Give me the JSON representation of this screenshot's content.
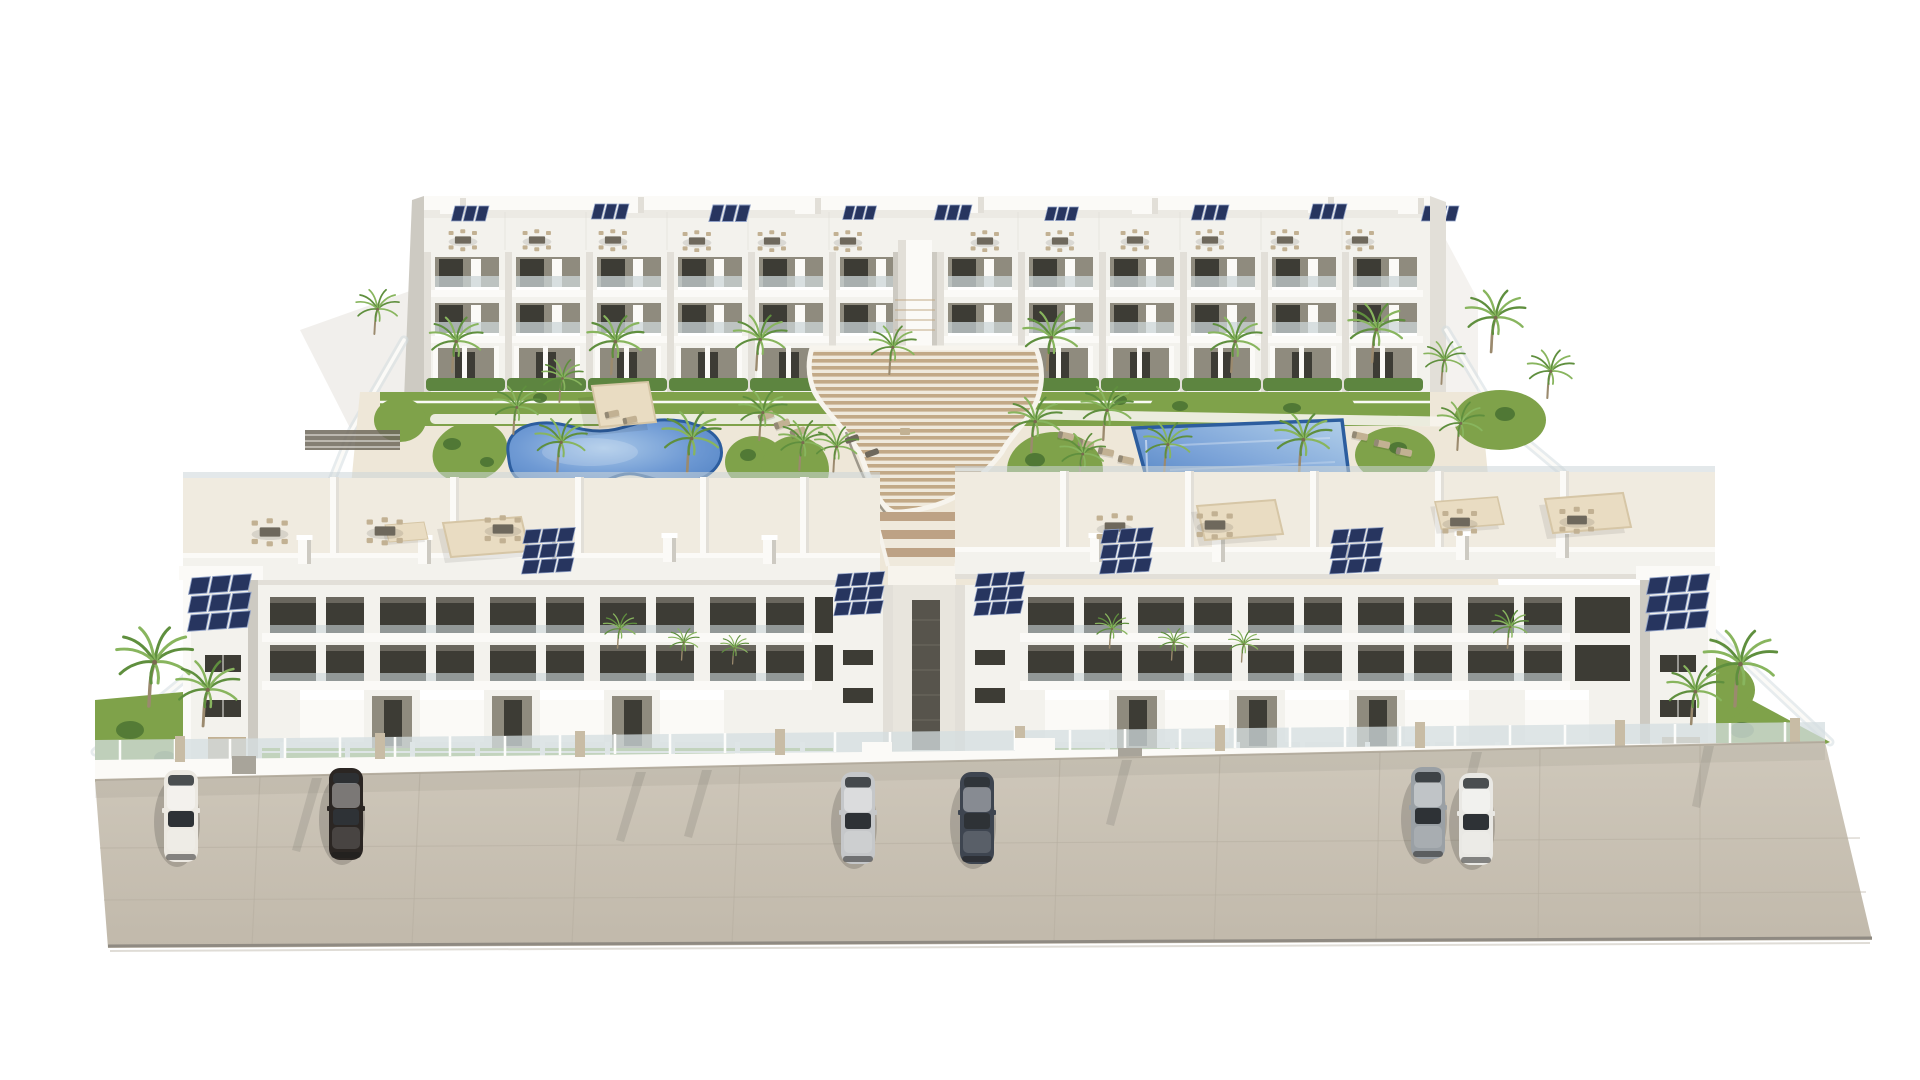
{
  "scene": {
    "description": "Aerial 3D architectural rendering of a white modern residential apartment complex: two rows of three-storey blocks around a landscaped courtyard with a kidney-shaped pool, a rectangular pool, a central curved wooden amphitheater walkway, rooftop terraces with dining sets and navy solar panels, many palm trees, a glass perimeter fence and six cars parked on the beige front street.",
    "objects": {
      "apartment_blocks": 4,
      "swimming_pools": 2,
      "pergolas": 2,
      "parked_cars": 6,
      "palm_trees": 35,
      "rooftop_solar_arrays": 16,
      "rooftop_dining_sets": 19,
      "sun_loungers": 17
    }
  },
  "palette": {
    "background": "#ffffff",
    "building_face": "#f3f2ed",
    "building_bright": "#fbfaf7",
    "building_shade": "#e2dfd8",
    "building_shade_dark": "#cdcac2",
    "porch_recess": "#8f8b7e",
    "window_dark": "#3d3c35",
    "balcony_glass": "#ccd5d8",
    "solar_panel": "#27355f",
    "solar_grid": "#8fa0c6",
    "terrace_floor": "#f0ebe0",
    "furniture_dark": "#6e685c",
    "furniture_tan": "#c2b193",
    "canopy": "#e9dcc2",
    "canopy_shade": "#d6c6a6",
    "deck": "#eee7d8",
    "path_white": "#f7f4ed",
    "grass": "#7fa24a",
    "grass_bright": "#8db254",
    "shrub": "#4c7433",
    "hedge": "#5d8540",
    "palm_frond": "#5f8f3e",
    "palm_frond_light": "#88b55e",
    "palm_trunk": "#9b8a6e",
    "pergola_slat": "#c2a987",
    "slat_gap": "#efe9dc",
    "step_wood": "#bda285",
    "pool_water_deep": "#4e80c2",
    "pool_water_light": "#a9c8e8",
    "pool_rim": "#2c5d9e",
    "street": "#cbc3b5",
    "street_seam": "#b7afa1",
    "street_edge": "#8f8a82",
    "fence_glass": "#d4dde0",
    "fence_post_tan": "#c8bca5",
    "shadow": "#5a5850"
  },
  "cars": [
    {
      "name": "white-sedan-left",
      "color": "#ece9e2",
      "x": 181,
      "y": 816
    },
    {
      "name": "black-sedan",
      "color": "#2b2623",
      "x": 346,
      "y": 814
    },
    {
      "name": "silver-sedan",
      "color": "#c5c7c9",
      "x": 858,
      "y": 818
    },
    {
      "name": "dark-blue-sedan",
      "color": "#3e4550",
      "x": 977,
      "y": 818
    },
    {
      "name": "gray-sedan",
      "color": "#9aa0a5",
      "x": 1428,
      "y": 813
    },
    {
      "name": "white-sedan-right",
      "color": "#e9e8e4",
      "x": 1476,
      "y": 819
    }
  ],
  "stamps": {
    "palm_court": [
      [
        453,
        372,
        0.8
      ],
      [
        560,
        402,
        0.62
      ],
      [
        612,
        374,
        0.85
      ],
      [
        757,
        370,
        0.8
      ],
      [
        890,
        374,
        0.7
      ],
      [
        1048,
        370,
        0.85
      ],
      [
        1232,
        372,
        0.8
      ],
      [
        1373,
        362,
        0.85
      ],
      [
        1442,
        384,
        0.62
      ],
      [
        375,
        334,
        0.65
      ],
      [
        1492,
        352,
        0.9
      ],
      [
        1548,
        398,
        0.7
      ],
      [
        514,
        434,
        0.7
      ],
      [
        558,
        472,
        0.78
      ],
      [
        688,
        472,
        0.88
      ],
      [
        760,
        440,
        0.72
      ],
      [
        834,
        472,
        0.66
      ],
      [
        1104,
        440,
        0.78
      ],
      [
        1165,
        472,
        0.72
      ],
      [
        1300,
        472,
        0.85
      ],
      [
        1458,
        450,
        0.7
      ],
      [
        800,
        470,
        0.72
      ],
      [
        1032,
        452,
        0.8
      ],
      [
        1080,
        480,
        0.68
      ]
    ],
    "palm_yard": [
      [
        618,
        648,
        0.5
      ],
      [
        682,
        660,
        0.46
      ],
      [
        733,
        664,
        0.42
      ],
      [
        1110,
        648,
        0.5
      ],
      [
        1172,
        660,
        0.46
      ],
      [
        1242,
        662,
        0.46
      ],
      [
        1508,
        648,
        0.55
      ]
    ],
    "palm_front": [
      [
        150,
        706,
        1.15
      ],
      [
        204,
        726,
        0.95
      ],
      [
        1692,
        724,
        0.85
      ],
      [
        1736,
        706,
        1.1
      ]
    ],
    "dine_back": [
      [
        463,
        240,
        0.9
      ],
      [
        537,
        240,
        0.9
      ],
      [
        613,
        240,
        0.9
      ],
      [
        697,
        241,
        0.9
      ],
      [
        772,
        241,
        0.9
      ],
      [
        848,
        241,
        0.9
      ],
      [
        985,
        241,
        0.9
      ],
      [
        1060,
        241,
        0.9
      ],
      [
        1135,
        240,
        0.9
      ],
      [
        1210,
        240,
        0.9
      ],
      [
        1285,
        240,
        0.9
      ],
      [
        1360,
        240,
        0.9
      ]
    ],
    "dine_front": [
      [
        270,
        532,
        1.15
      ],
      [
        385,
        531,
        1.15
      ],
      [
        503,
        529,
        1.15
      ],
      [
        1115,
        527,
        1.15
      ],
      [
        1215,
        525,
        1.15
      ],
      [
        1460,
        522,
        1.1
      ],
      [
        1577,
        520,
        1.1
      ]
    ],
    "sol3_back": [
      [
        455,
        206,
        1.0
      ],
      [
        595,
        204,
        1.0
      ],
      [
        713,
        205,
        1.1
      ],
      [
        846,
        206,
        0.9
      ],
      [
        938,
        205,
        1.0
      ],
      [
        1048,
        207,
        0.9
      ],
      [
        1195,
        205,
        1.0
      ],
      [
        1313,
        204,
        1.0
      ],
      [
        1425,
        206,
        1.0
      ]
    ],
    "sol9_front": [
      [
        192,
        578,
        1.15,
        -4
      ],
      [
        526,
        530,
        0.95,
        -3
      ],
      [
        838,
        574,
        0.9,
        -3
      ],
      [
        978,
        574,
        0.9,
        -3
      ],
      [
        1104,
        530,
        0.95,
        -3
      ],
      [
        1334,
        530,
        0.95,
        -3
      ],
      [
        1650,
        578,
        1.15,
        -4
      ]
    ],
    "lounger": [
      [
        766,
        416,
        1,
        -20
      ],
      [
        782,
        424,
        1,
        -20
      ],
      [
        798,
        432,
        1,
        -20
      ],
      [
        676,
        494,
        0.9,
        0
      ],
      [
        698,
        498,
        0.9,
        0
      ],
      [
        888,
        408,
        1,
        0
      ],
      [
        912,
        412,
        1,
        0
      ],
      [
        936,
        416,
        1,
        0
      ],
      [
        1066,
        436,
        1,
        12
      ],
      [
        1086,
        444,
        1,
        12
      ],
      [
        1106,
        452,
        1,
        12
      ],
      [
        1126,
        460,
        1,
        12
      ],
      [
        1360,
        436,
        1,
        12
      ],
      [
        1382,
        444,
        1,
        12
      ],
      [
        1404,
        452,
        1,
        12
      ],
      [
        612,
        414,
        0.9,
        -12
      ],
      [
        630,
        420,
        0.9,
        -12
      ]
    ],
    "canopy": [
      [
        443,
        517,
        1,
        0
      ],
      [
        385,
        522,
        0.5,
        0
      ],
      [
        1197,
        500,
        1,
        0
      ],
      [
        1435,
        497,
        0.8,
        0
      ],
      [
        1545,
        493,
        1,
        0
      ]
    ],
    "chimney": [
      [
        298,
        538,
        1,
        0
      ],
      [
        418,
        538,
        1,
        0
      ],
      [
        543,
        536,
        1,
        0
      ],
      [
        663,
        536,
        1,
        0
      ],
      [
        763,
        538,
        1,
        0
      ],
      [
        1090,
        536,
        1,
        0
      ],
      [
        1212,
        536,
        1,
        0
      ],
      [
        1336,
        534,
        1,
        0
      ],
      [
        1456,
        534,
        1,
        0
      ],
      [
        1556,
        532,
        1,
        0
      ]
    ],
    "bulkhead": [
      [
        440,
        198,
        1,
        0
      ],
      [
        618,
        197,
        1,
        0
      ],
      [
        795,
        198,
        1,
        0
      ],
      [
        958,
        197,
        1,
        0
      ],
      [
        1132,
        198,
        1,
        0
      ],
      [
        1308,
        197,
        1,
        0
      ],
      [
        1398,
        198,
        1,
        0
      ]
    ],
    "fence_post": [
      [
        120,
        760
      ],
      [
        175,
        759
      ],
      [
        230,
        759
      ],
      [
        285,
        758
      ],
      [
        340,
        757
      ],
      [
        395,
        757
      ],
      [
        450,
        756
      ],
      [
        505,
        756
      ],
      [
        560,
        755
      ],
      [
        615,
        754
      ],
      [
        670,
        754
      ],
      [
        725,
        753
      ],
      [
        780,
        753
      ],
      [
        835,
        752
      ],
      [
        890,
        752
      ],
      [
        1015,
        750
      ],
      [
        1070,
        750
      ],
      [
        1125,
        749
      ],
      [
        1180,
        749
      ],
      [
        1235,
        748
      ],
      [
        1290,
        747
      ],
      [
        1345,
        747
      ],
      [
        1400,
        746
      ],
      [
        1455,
        746
      ],
      [
        1510,
        745
      ],
      [
        1565,
        745
      ],
      [
        1620,
        744
      ],
      [
        1675,
        744
      ],
      [
        1730,
        743
      ],
      [
        1785,
        742
      ]
    ],
    "fence_pillar": [
      [
        180,
        760
      ],
      [
        380,
        757
      ],
      [
        580,
        755
      ],
      [
        780,
        753
      ],
      [
        1020,
        750
      ],
      [
        1220,
        749
      ],
      [
        1420,
        746
      ],
      [
        1620,
        744
      ],
      [
        1795,
        742
      ]
    ]
  }
}
